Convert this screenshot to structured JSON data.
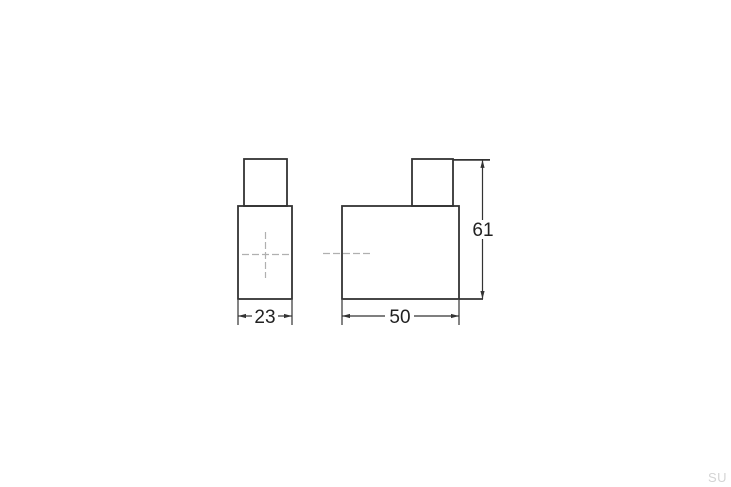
{
  "drawing": {
    "title": "furniture-handle-technical-drawing",
    "dimensions": {
      "front_width": "23",
      "side_depth": "50",
      "side_height": "61"
    },
    "watermark": "SU",
    "colors": {
      "outline": "#333333",
      "dimension_lines": "#333333",
      "dimension_text": "#222222",
      "centerline": "#b0b0b0",
      "watermark_text": "#d4d4d4",
      "background": "#ffffff"
    }
  }
}
